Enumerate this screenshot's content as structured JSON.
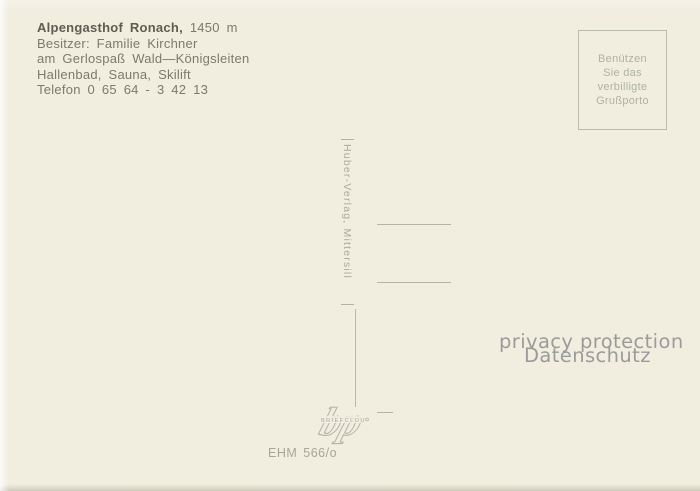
{
  "card": {
    "info_block": {
      "line1_bold": "Alpengasthof Ronach,",
      "line1_regular": " 1450 m",
      "line2": "Besitzer: Familie Kirchner",
      "line3": "am Gerlospaß Wald—Königsleiten",
      "line4": "Hallenbad, Sauna, Skilift",
      "line5": "Telefon 0 65 64 - 3 42 13"
    },
    "stamp_box": {
      "lines": [
        "Benützen",
        "Sie das",
        "verbilligte",
        "Grußporto"
      ]
    },
    "publisher_imprint": "Huber-Verlag, Mittersill",
    "logo": {
      "letters": "bp",
      "small_text": "BRIEFCLOU"
    },
    "order_number": "EHM 566/o",
    "watermark": {
      "line1": "privacy protection",
      "line2": "Datenschutz"
    },
    "colors": {
      "background": "#f1eee0",
      "ink": "#7b7a6c",
      "ink_bold": "#5e5d51",
      "stamp": "#aeb2a1",
      "watermark": "#9b9b9b"
    }
  }
}
